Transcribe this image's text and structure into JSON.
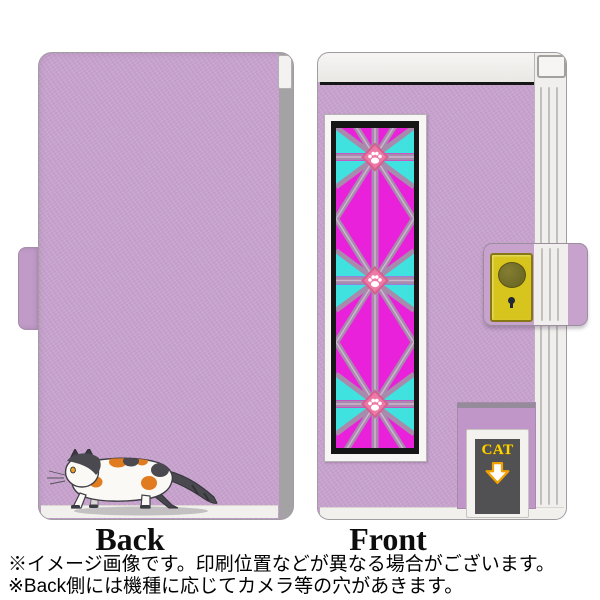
{
  "labels": {
    "back": "Back",
    "front": "Front"
  },
  "badge": {
    "cat": "CAT"
  },
  "notes": {
    "line1": "※イメージ画像です。印刷位置などが異なる場合がございます。",
    "line2": "※Back側には機種に応じてカメラ等の穴があきます。"
  },
  "colors": {
    "case_lavender": "#c7a2cd",
    "magenta": "#ea21da",
    "cyan": "#3fe2de",
    "lattice": "#a78aac",
    "lattice_light": "#cdb6d0",
    "frame_black": "#161616",
    "frame_white": "#f7f6f4",
    "paw_pink": "#ed7aa6",
    "paw_pink_dark": "#d75f90",
    "clasp_yellow": "#d7c41d",
    "clasp_yellow_dark": "#857714",
    "clasp_button": "#6e6a26",
    "cat_text_yellow": "#f8d800",
    "arrow_orange": "#f0a000",
    "label_panel_gray": "#515153",
    "spine_white": "#f0efed",
    "edge_gray": "#a5a2a5",
    "floor_white": "#f2f0ec",
    "cat_orange": "#e07b1f",
    "cat_dark": "#4a4950",
    "shadow_gray": "#b5b4b6"
  }
}
